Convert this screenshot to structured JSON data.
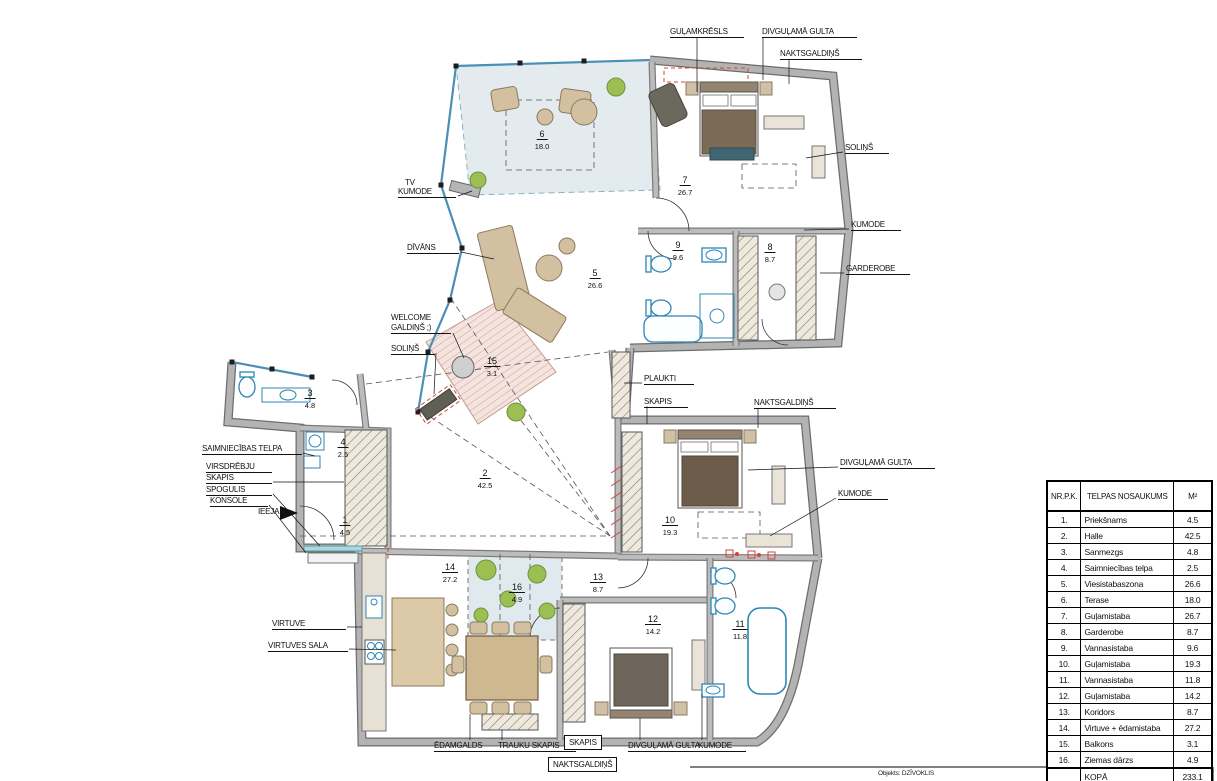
{
  "footer": {
    "objekts": "Objekts: DZĪVOKLIS"
  },
  "table": {
    "headers": {
      "nr": "NR.P.K.",
      "name": "TELPAS NOSAUKUMS",
      "area": "M²"
    },
    "rows": [
      {
        "nr": "1.",
        "name": "Priekšnams",
        "area": "4.5"
      },
      {
        "nr": "2.",
        "name": "Halle",
        "area": "42.5"
      },
      {
        "nr": "3.",
        "name": "Sanmezgs",
        "area": "4.8"
      },
      {
        "nr": "4.",
        "name": "Saimniecības telpa",
        "area": "2.5"
      },
      {
        "nr": "5.",
        "name": "Viesistabaszona",
        "area": "26.6"
      },
      {
        "nr": "6.",
        "name": "Terase",
        "area": "18.0"
      },
      {
        "nr": "7.",
        "name": "Guļamistaba",
        "area": "26.7"
      },
      {
        "nr": "8.",
        "name": "Garderobe",
        "area": "8.7"
      },
      {
        "nr": "9.",
        "name": "Vannasistaba",
        "area": "9.6"
      },
      {
        "nr": "10.",
        "name": "Guļamistaba",
        "area": "19.3"
      },
      {
        "nr": "11.",
        "name": "Vannasistaba",
        "area": "11.8"
      },
      {
        "nr": "12.",
        "name": "Guļamistaba",
        "area": "14.2"
      },
      {
        "nr": "13.",
        "name": "Koridors",
        "area": "8.7"
      },
      {
        "nr": "14.",
        "name": "Virtuve + ēdamistaba",
        "area": "27.2"
      },
      {
        "nr": "15.",
        "name": "Balkons",
        "area": "3.1"
      },
      {
        "nr": "16.",
        "name": "Ziemas dārzs",
        "area": "4.9"
      }
    ],
    "total": {
      "label": "KOPĀ",
      "area": "233.1"
    }
  },
  "annotations": [
    {
      "id": "gulamkresls",
      "text": "GUĻAMKRĒSLS",
      "x": 670,
      "y": 27,
      "w": 74,
      "u": true,
      "box": false
    },
    {
      "id": "divgulama-gulta-7",
      "text": "DIVGUĻAMĀ GULTA",
      "x": 762,
      "y": 27,
      "w": 95,
      "u": true,
      "box": false
    },
    {
      "id": "naktsgaldins-7",
      "text": "NAKTSGALDIŅŠ",
      "x": 780,
      "y": 49,
      "w": 82,
      "u": true,
      "box": false
    },
    {
      "id": "solins-7",
      "text": "SOLIŅŠ",
      "x": 845,
      "y": 143,
      "w": 44,
      "u": true,
      "box": false
    },
    {
      "id": "kumode-7",
      "text": "KUMODE",
      "x": 851,
      "y": 220,
      "w": 50,
      "u": true,
      "box": false
    },
    {
      "id": "garderobe",
      "text": "GARDEROBE",
      "x": 846,
      "y": 264,
      "w": 64,
      "u": true,
      "box": false
    },
    {
      "id": "tv",
      "text": "TV",
      "x": 405,
      "y": 178,
      "w": 0,
      "u": false,
      "box": false
    },
    {
      "id": "tv-kumode",
      "text": "KUMODE",
      "x": 398,
      "y": 187,
      "w": 58,
      "u": true,
      "box": false
    },
    {
      "id": "divans",
      "text": "DĪVĀNS",
      "x": 407,
      "y": 243,
      "w": 52,
      "u": true,
      "box": false
    },
    {
      "id": "welcome",
      "text": "WELCOME",
      "x": 391,
      "y": 313,
      "w": 0,
      "u": false,
      "box": false
    },
    {
      "id": "welcome-galdins",
      "text": "GALDIŅŠ ;)",
      "x": 391,
      "y": 323,
      "w": 60,
      "u": true,
      "box": false
    },
    {
      "id": "solins-hall",
      "text": "SOLIŅŠ",
      "x": 391,
      "y": 344,
      "w": 44,
      "u": true,
      "box": false
    },
    {
      "id": "plaukti",
      "text": "PLAUKTI",
      "x": 644,
      "y": 374,
      "w": 50,
      "u": true,
      "box": false
    },
    {
      "id": "skapis-koridors",
      "text": "SKAPIS",
      "x": 644,
      "y": 397,
      "w": 44,
      "u": true,
      "box": false
    },
    {
      "id": "naktsgaldins-10",
      "text": "NAKTSGALDIŅŠ",
      "x": 754,
      "y": 398,
      "w": 82,
      "u": true,
      "box": false
    },
    {
      "id": "divgulama-gulta-10",
      "text": "DIVGUĻAMĀ GULTA",
      "x": 840,
      "y": 458,
      "w": 95,
      "u": true,
      "box": false
    },
    {
      "id": "kumode-10",
      "text": "KUMODE",
      "x": 838,
      "y": 489,
      "w": 50,
      "u": true,
      "box": false
    },
    {
      "id": "saimniecibas-telpa",
      "text": "SAIMNIECĪBAS TELPA",
      "x": 202,
      "y": 444,
      "w": 100,
      "u": true,
      "box": false
    },
    {
      "id": "virsdrebju",
      "text": "VIRSDRĒBJU",
      "x": 206,
      "y": 462,
      "w": 66,
      "u": true,
      "box": false
    },
    {
      "id": "virsdrebju-skapis",
      "text": "SKAPIS",
      "x": 206,
      "y": 473,
      "w": 66,
      "u": true,
      "box": false
    },
    {
      "id": "spogulis",
      "text": "SPOGULIS",
      "x": 206,
      "y": 485,
      "w": 66,
      "u": true,
      "box": false
    },
    {
      "id": "konsole",
      "text": "KONSOLE",
      "x": 210,
      "y": 496,
      "w": 58,
      "u": true,
      "box": false
    },
    {
      "id": "ieeja",
      "text": "IEEJA",
      "x": 258,
      "y": 507,
      "w": 0,
      "u": false,
      "box": false
    },
    {
      "id": "virtuve",
      "text": "VIRTUVE",
      "x": 272,
      "y": 619,
      "w": 74,
      "u": true,
      "box": false
    },
    {
      "id": "virtuves-sala",
      "text": "VIRTUVES SALA",
      "x": 268,
      "y": 641,
      "w": 80,
      "u": true,
      "box": false
    },
    {
      "id": "edamgalds",
      "text": "ĒDAMGALDS",
      "x": 434,
      "y": 741,
      "w": 64,
      "u": true,
      "box": false
    },
    {
      "id": "trauku-skapis",
      "text": "TRAUKU SKAPIS",
      "x": 498,
      "y": 741,
      "w": 78,
      "u": true,
      "box": false
    },
    {
      "id": "skapis-bottom",
      "text": "SKAPIS",
      "x": 564,
      "y": 735,
      "w": 0,
      "u": false,
      "box": true
    },
    {
      "id": "naktsgaldins-bottom",
      "text": "NAKTSGALDIŅŠ",
      "x": 548,
      "y": 757,
      "w": 0,
      "u": false,
      "box": true
    },
    {
      "id": "divgulama-gulta-12",
      "text": "DIVGUĻAMĀ GULTA",
      "x": 628,
      "y": 741,
      "w": 92,
      "u": true,
      "box": false
    },
    {
      "id": "kumode-12",
      "text": "KUMODE",
      "x": 698,
      "y": 741,
      "w": 48,
      "u": true,
      "box": false
    }
  ],
  "rooms": [
    {
      "id": "prieksnams",
      "nr": "1",
      "area": "4.5",
      "x": 345,
      "y": 510
    },
    {
      "id": "halle",
      "nr": "2",
      "area": "42.5",
      "x": 485,
      "y": 463
    },
    {
      "id": "sanmezgs",
      "nr": "3",
      "area": "4.8",
      "x": 310,
      "y": 383
    },
    {
      "id": "saimniecibas",
      "nr": "4",
      "area": "2.5",
      "x": 343,
      "y": 432
    },
    {
      "id": "viesistaba",
      "nr": "5",
      "area": "26.6",
      "x": 595,
      "y": 263
    },
    {
      "id": "terase",
      "nr": "6",
      "area": "18.0",
      "x": 542,
      "y": 124
    },
    {
      "id": "gulamistaba-7",
      "nr": "7",
      "area": "26.7",
      "x": 685,
      "y": 170
    },
    {
      "id": "garderobe-8",
      "nr": "8",
      "area": "8.7",
      "x": 770,
      "y": 237
    },
    {
      "id": "vannasistaba-9",
      "nr": "9",
      "area": "9.6",
      "x": 678,
      "y": 235
    },
    {
      "id": "gulamistaba-10",
      "nr": "10",
      "area": "19.3",
      "x": 670,
      "y": 510
    },
    {
      "id": "vannasistaba-11",
      "nr": "11",
      "area": "11.8",
      "x": 740,
      "y": 614
    },
    {
      "id": "gulamistaba-12",
      "nr": "12",
      "area": "14.2",
      "x": 653,
      "y": 609
    },
    {
      "id": "koridors",
      "nr": "13",
      "area": "8.7",
      "x": 598,
      "y": 567
    },
    {
      "id": "virtuve-14",
      "nr": "14",
      "area": "27.2",
      "x": 450,
      "y": 557
    },
    {
      "id": "balkons",
      "nr": "15",
      "area": "3.1",
      "x": 492,
      "y": 351
    },
    {
      "id": "ziemas-darzs",
      "nr": "16",
      "area": "4.9",
      "x": 517,
      "y": 577
    }
  ]
}
